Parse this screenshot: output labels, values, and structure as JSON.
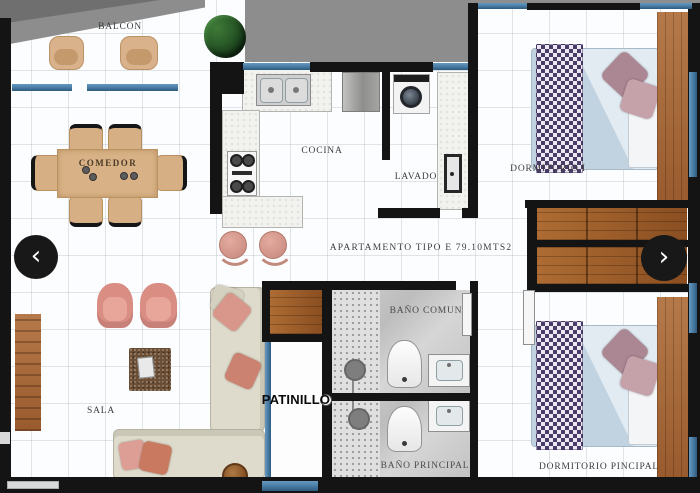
{
  "viewer": {
    "prev_icon": "‹",
    "next_icon": "›"
  },
  "floorplan": {
    "apartment_label": "APARTAMENTO TIPO E 79.10MTS2",
    "rooms": {
      "balcony": "BALCON",
      "dining_room": "COMEDOR",
      "kitchen": "COCINA",
      "laundry": "LAVADO",
      "bedroom_1": "DORMITORIO I",
      "shared_bathroom": "BAÑO COMUN",
      "light_well": "PATINILLO",
      "living_room": "SALA",
      "main_bathroom": "BAÑO PRINCIPAL",
      "main_bedroom": "DORMITORIO PINCIPAL"
    },
    "colors": {
      "wall": "#141414",
      "window_glass": "#4d80a8",
      "exterior": "#8d8d8d",
      "wood": "#9a5b2b",
      "sofa_cream": "#dfdbcc",
      "accent_pink": "#dd9a8e",
      "bed_blue": "#c7d6e4",
      "throw_purple": "#4a3c68",
      "bath_tile": "#c8c8c8"
    }
  }
}
